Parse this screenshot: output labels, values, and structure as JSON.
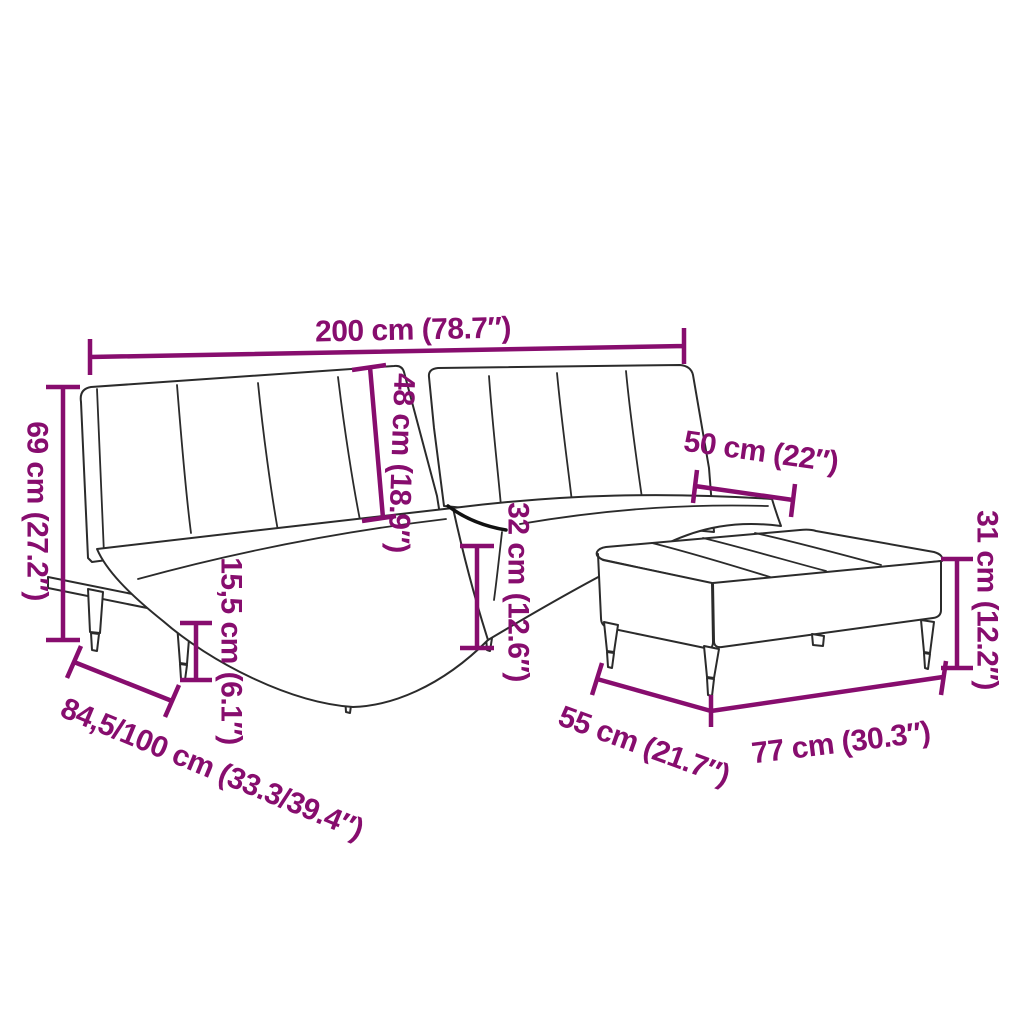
{
  "colors": {
    "accent": "#870D6E",
    "line_art": "#2B2B2B",
    "background": "#FFFFFF"
  },
  "diagram": {
    "subject": "sofa-bed-with-ottoman-dimension-diagram"
  },
  "dimensions": {
    "sofa_width": {
      "label": "200 cm (78.7″)"
    },
    "sofa_height": {
      "label": "69 cm (27.2″)"
    },
    "backrest_height": {
      "label": "48 cm (18.9″)"
    },
    "seat_height": {
      "label": "32 cm (12.6″)"
    },
    "leg_height": {
      "label": "15,5 cm (6.1″)"
    },
    "sofa_depth": {
      "label": "84,5/100 cm (33.3/39.4″)"
    },
    "ottoman_top_width": {
      "label": "50 cm (22″)"
    },
    "ottoman_height": {
      "label": "31 cm (12.2″)"
    },
    "ottoman_depth": {
      "label": "55 cm (21.7″)"
    },
    "ottoman_width": {
      "label": "77 cm (30.3″)"
    }
  }
}
